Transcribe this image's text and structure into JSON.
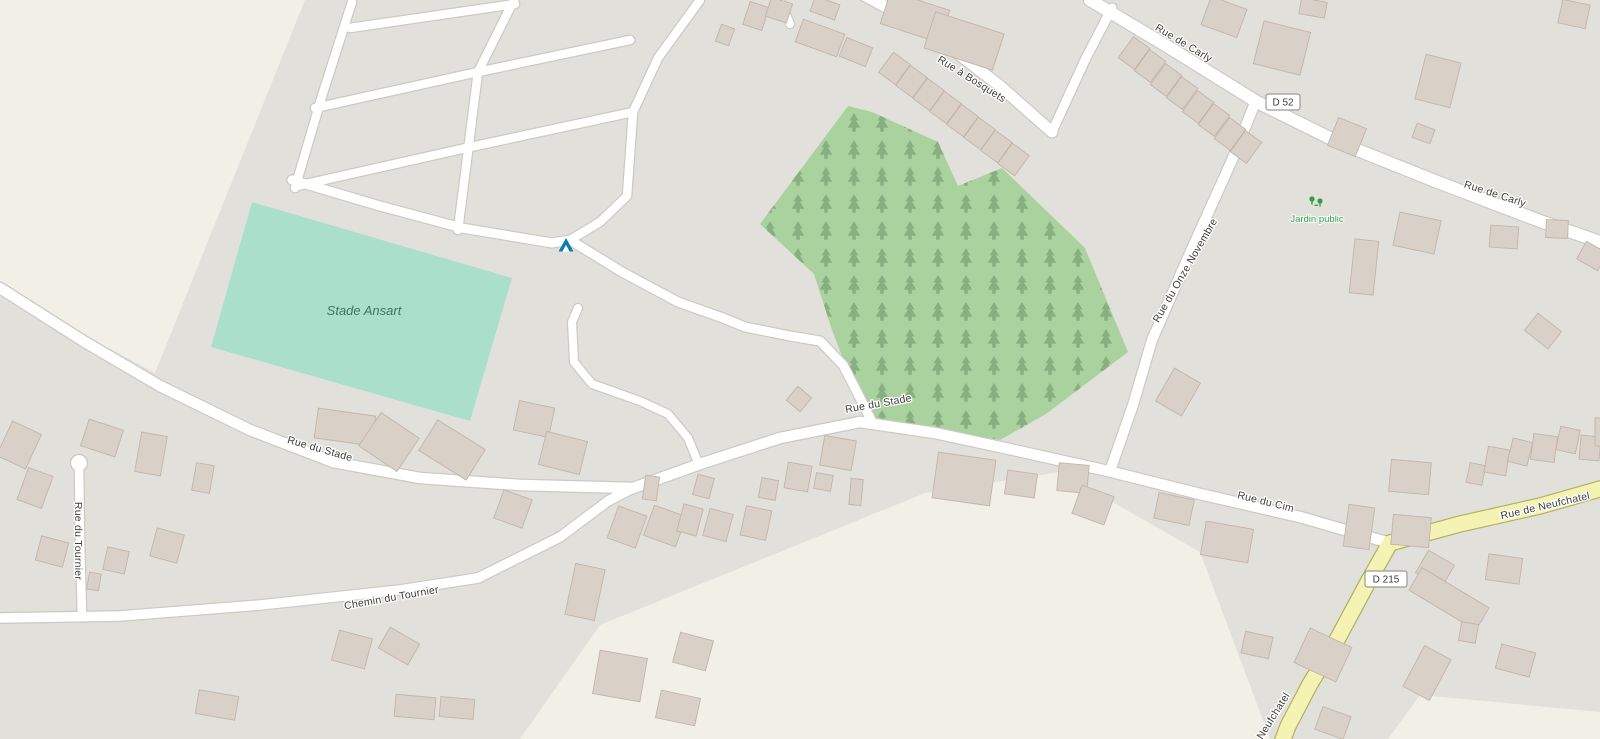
{
  "map": {
    "colors": {
      "background": "#e2e0db",
      "farmland": "#f2efe6",
      "pitch": "#aae0cb",
      "forest": "#aad29f",
      "tree": "#84ab7c",
      "building_fill": "#d9d0c8",
      "building_stroke": "#c2b5a8",
      "road_casing": "#cbc9c3",
      "road_fill": "#ffffff",
      "secondary_fill": "#f4f3b4",
      "secondary_casing": "#b0b060",
      "badge_bg": "#ffffff",
      "badge_border": "#9b9b98",
      "campsite_icon": "#0f7cad",
      "park_icon": "#2f9e44"
    },
    "areas": {
      "farmland": [
        "0,0 305,0 155,373 0,290",
        "520,739 600,625 925,493 1060,472 1200,552 1270,739",
        "1388,739 1420,695 1600,712 1600,739"
      ],
      "forest": "760,224 848,106 872,112 938,142 958,186 1002,168 1085,248 1128,352 1046,414 1000,440 930,428 868,416 852,382 832,330 814,274",
      "pitch": "252,202 512,278 470,421 211,347"
    },
    "roads": [
      {
        "n": "rue-de-carly",
        "d": "M1090,0 L1170,48 L1257,102 L1340,143 L1440,183 L1540,221 L1600,242",
        "w": 12
      },
      {
        "n": "rue-a-bosquets",
        "d": "M862,-6 L925,28 L1000,86 L1052,132",
        "w": 11
      },
      {
        "n": "bosquets-carly-link",
        "d": "M1052,132 L1085,60 L1112,8",
        "w": 9
      },
      {
        "n": "rue-du-onze-novembre",
        "d": "M1255,103 L1232,160 L1186,262 L1152,340 L1133,405 L1110,471",
        "w": 10
      },
      {
        "n": "rue-du-stade-west",
        "d": "M0,288 L85,342 L160,386 L250,430 L333,462 L420,478 L520,485 L633,488",
        "w": 10.5
      },
      {
        "n": "rue-du-stade-cim",
        "d": "M633,488 L700,464 L780,438 L860,422 L935,433 L1000,447 L1108,471 L1200,494 L1300,517 L1390,543",
        "w": 10.5
      },
      {
        "n": "chemin-du-tournier",
        "d": "M0,618 L120,616 L260,605 L400,590 L478,578 L560,537 L608,501 L633,488",
        "w": 9.5
      },
      {
        "n": "rue-du-tournier",
        "d": "M79,466 L80,540 L82,616",
        "w": 8.5
      },
      {
        "n": "grid-road-1",
        "d": "M350,28 L515,4",
        "w": 8.5
      },
      {
        "n": "grid-road-2",
        "d": "M315,108 L478,72 L630,40",
        "w": 8.5
      },
      {
        "n": "grid-road-3",
        "d": "M297,186 L466,148 L633,112",
        "w": 8.5
      },
      {
        "n": "grid-road-4",
        "d": "M352,2 L322,96 L295,188",
        "w": 8.5
      },
      {
        "n": "grid-road-5",
        "d": "M514,0 L478,72 L458,230",
        "w": 8.5
      },
      {
        "n": "grid-road-6",
        "d": "M700,0 L658,58 L633,112 L627,196 L600,222 L570,240",
        "w": 8.5
      },
      {
        "n": "campground-access",
        "d": "M292,180 L380,206 L462,228 L552,243 L570,240",
        "w": 9
      },
      {
        "n": "stade-link",
        "d": "M570,240 L622,272 L678,302 L723,318 L745,327 L790,336 L820,341 L843,365 L857,392 L872,422",
        "w": 9
      },
      {
        "n": "dead-end-lane",
        "d": "M578,308 L572,322 L574,362 L592,384 L640,401 L668,414 L688,438 L697,460",
        "w": 8
      },
      {
        "n": "top-lane",
        "d": "M778,-4 L790,24",
        "w": 8
      },
      {
        "n": "rue-de-neufchatel-ne",
        "d": "M1390,543 L1460,524 L1540,506 L1600,489",
        "w": 15,
        "t": "secondary"
      },
      {
        "n": "rue-de-neufchatel-d215",
        "d": "M1390,543 L1368,582 L1338,638 L1310,684 L1288,726 L1281,745",
        "w": 15,
        "t": "secondary"
      }
    ],
    "culdesac": {
      "x": 79,
      "y": 463,
      "r": 8.5
    },
    "buildings": [
      [
        718,
        26,
        14,
        18,
        20
      ],
      [
        746,
        4,
        20,
        24,
        18
      ],
      [
        768,
        0,
        22,
        20,
        18
      ],
      [
        798,
        26,
        44,
        24,
        20
      ],
      [
        812,
        0,
        26,
        16,
        20
      ],
      [
        842,
        42,
        28,
        20,
        22
      ],
      [
        884,
        0,
        62,
        34,
        18
      ],
      [
        928,
        22,
        72,
        38,
        18
      ],
      [
        884,
        56,
        21,
        25,
        36
      ],
      [
        901,
        69,
        21,
        25,
        36
      ],
      [
        918,
        82,
        21,
        25,
        36
      ],
      [
        935,
        95,
        21,
        25,
        36
      ],
      [
        952,
        108,
        21,
        25,
        36
      ],
      [
        969,
        121,
        21,
        25,
        36
      ],
      [
        986,
        134,
        21,
        25,
        36
      ],
      [
        1003,
        147,
        21,
        25,
        36
      ],
      [
        1124,
        40,
        20,
        26,
        36
      ],
      [
        1140,
        53,
        20,
        26,
        36
      ],
      [
        1156,
        67,
        20,
        26,
        36
      ],
      [
        1172,
        80,
        20,
        26,
        36
      ],
      [
        1188,
        94,
        20,
        26,
        36
      ],
      [
        1204,
        107,
        20,
        26,
        36
      ],
      [
        1220,
        121,
        20,
        26,
        36
      ],
      [
        1236,
        134,
        20,
        26,
        36
      ],
      [
        1205,
        2,
        38,
        30,
        20
      ],
      [
        1258,
        26,
        48,
        44,
        14
      ],
      [
        1300,
        0,
        26,
        16,
        10
      ],
      [
        1332,
        122,
        30,
        30,
        22
      ],
      [
        1414,
        126,
        19,
        15,
        20
      ],
      [
        1420,
        58,
        36,
        46,
        14
      ],
      [
        1560,
        2,
        28,
        24,
        12
      ],
      [
        1352,
        240,
        24,
        54,
        6
      ],
      [
        1396,
        216,
        42,
        34,
        12
      ],
      [
        1490,
        226,
        28,
        22,
        4
      ],
      [
        1546,
        220,
        22,
        18,
        2
      ],
      [
        1580,
        246,
        24,
        20,
        30
      ],
      [
        1528,
        320,
        30,
        22,
        38
      ],
      [
        1468,
        464,
        16,
        20,
        12
      ],
      [
        1486,
        448,
        22,
        26,
        10
      ],
      [
        1510,
        440,
        20,
        24,
        14
      ],
      [
        1532,
        435,
        24,
        26,
        8
      ],
      [
        1558,
        428,
        20,
        24,
        12
      ],
      [
        1580,
        436,
        20,
        24,
        5
      ],
      [
        1595,
        418,
        14,
        28,
        0
      ],
      [
        1390,
        461,
        40,
        32,
        5
      ],
      [
        1346,
        506,
        26,
        42,
        8
      ],
      [
        1392,
        516,
        38,
        30,
        5
      ],
      [
        1487,
        556,
        34,
        26,
        8
      ],
      [
        1420,
        556,
        30,
        26,
        30
      ],
      [
        1410,
        586,
        78,
        26,
        31
      ],
      [
        1412,
        650,
        30,
        46,
        28
      ],
      [
        1300,
        636,
        46,
        38,
        25
      ],
      [
        1318,
        711,
        30,
        24,
        20
      ],
      [
        1243,
        634,
        28,
        22,
        12
      ],
      [
        1460,
        623,
        17,
        19,
        10
      ],
      [
        1498,
        648,
        35,
        25,
        15
      ],
      [
        1156,
        496,
        36,
        26,
        12
      ],
      [
        1203,
        525,
        48,
        34,
        10
      ],
      [
        1163,
        373,
        30,
        38,
        30
      ],
      [
        822,
        438,
        32,
        30,
        10
      ],
      [
        935,
        456,
        58,
        46,
        8
      ],
      [
        1006,
        472,
        30,
        24,
        8
      ],
      [
        1058,
        464,
        30,
        28,
        5
      ],
      [
        1076,
        490,
        34,
        30,
        20
      ],
      [
        850,
        479,
        12,
        26,
        5
      ],
      [
        815,
        474,
        17,
        16,
        10
      ],
      [
        786,
        464,
        24,
        26,
        10
      ],
      [
        743,
        508,
        26,
        30,
        12
      ],
      [
        760,
        479,
        17,
        20,
        10
      ],
      [
        695,
        476,
        17,
        21,
        15
      ],
      [
        648,
        510,
        34,
        32,
        20
      ],
      [
        644,
        476,
        14,
        24,
        8
      ],
      [
        790,
        390,
        18,
        18,
        40
      ],
      [
        612,
        510,
        30,
        34,
        20
      ],
      [
        680,
        506,
        20,
        28,
        15
      ],
      [
        706,
        511,
        24,
        28,
        15
      ],
      [
        570,
        566,
        30,
        52,
        12
      ],
      [
        498,
        494,
        30,
        30,
        20
      ],
      [
        676,
        636,
        34,
        31,
        15
      ],
      [
        596,
        654,
        48,
        44,
        10
      ],
      [
        658,
        694,
        40,
        28,
        12
      ],
      [
        316,
        412,
        58,
        30,
        8
      ],
      [
        366,
        422,
        46,
        40,
        34
      ],
      [
        424,
        432,
        56,
        36,
        32
      ],
      [
        516,
        404,
        36,
        30,
        12
      ],
      [
        542,
        436,
        42,
        34,
        14
      ],
      [
        3,
        426,
        32,
        38,
        25
      ],
      [
        22,
        471,
        26,
        34,
        20
      ],
      [
        38,
        539,
        28,
        25,
        15
      ],
      [
        84,
        424,
        36,
        28,
        18
      ],
      [
        138,
        434,
        26,
        40,
        10
      ],
      [
        194,
        464,
        18,
        28,
        10
      ],
      [
        105,
        549,
        22,
        23,
        12
      ],
      [
        153,
        531,
        28,
        29,
        15
      ],
      [
        88,
        573,
        12,
        17,
        10
      ],
      [
        197,
        693,
        40,
        24,
        10
      ],
      [
        335,
        634,
        34,
        31,
        15
      ],
      [
        382,
        634,
        34,
        24,
        30
      ],
      [
        395,
        696,
        40,
        22,
        5
      ],
      [
        440,
        698,
        34,
        20,
        5
      ]
    ],
    "road_labels": [
      {
        "text": "Rue de Carly",
        "x": 1182,
        "y": 46,
        "rot": 31
      },
      {
        "text": "Rue de Carly",
        "x": 1494,
        "y": 197,
        "rot": 18
      },
      {
        "text": "Rue à Bosquets",
        "x": 970,
        "y": 82,
        "rot": 32
      },
      {
        "text": "Rue du Onze Novembre",
        "x": 1188,
        "y": 272,
        "rot": -60
      },
      {
        "text": "Rue du Stade",
        "x": 319,
        "y": 452,
        "rot": 16
      },
      {
        "text": "Rue du Stade",
        "x": 879,
        "y": 407,
        "rot": -10
      },
      {
        "text": "Rue du Cim",
        "x": 1265,
        "y": 505,
        "rot": 14
      },
      {
        "text": "Rue de Neufchatel",
        "x": 1546,
        "y": 509,
        "rot": -13
      },
      {
        "text": "Rue de Neufchatel",
        "x": 1266,
        "y": 734,
        "rot": -58
      },
      {
        "text": "Chemin du Tournier",
        "x": 392,
        "y": 601,
        "rot": -10
      },
      {
        "text": "Rue du Tournier",
        "x": 75,
        "y": 541,
        "rot": 90
      }
    ],
    "badges": [
      {
        "text": "D 52",
        "x": 1283,
        "y": 102,
        "w": 34,
        "h": 16
      },
      {
        "text": "D 215",
        "x": 1386,
        "y": 579,
        "w": 42,
        "h": 16
      }
    ],
    "place_labels": {
      "pitch": {
        "text": "Stade Ansart",
        "x": 364,
        "y": 315
      },
      "park": {
        "text": "Jardin public",
        "x": 1317,
        "y": 222
      }
    },
    "icons": {
      "campsite": {
        "x": 566,
        "y": 245
      },
      "park": {
        "x": 1316,
        "y": 202
      }
    }
  }
}
